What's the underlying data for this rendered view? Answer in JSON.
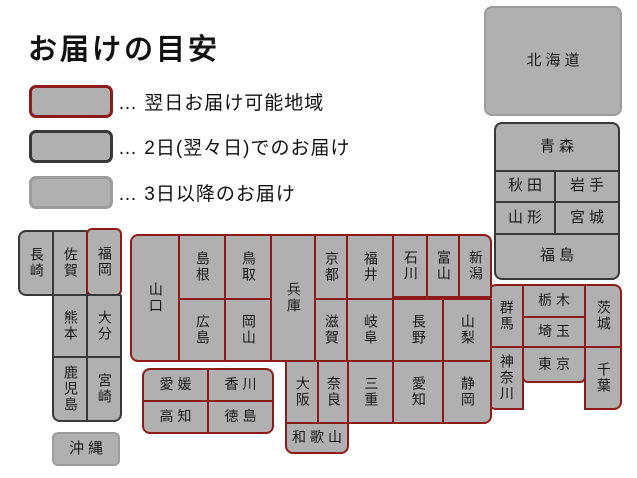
{
  "title": "お届けの目安",
  "legend": {
    "items": [
      {
        "zone": "next-day",
        "label": "… 翌日お届け可能地域"
      },
      {
        "zone": "two-days",
        "label": "… 2日(翌々日)でのお届け"
      },
      {
        "zone": "three-plus",
        "label": "… 3日以降のお届け"
      }
    ]
  },
  "colors": {
    "next-day": "#8e1b1b",
    "two-days": "#383838",
    "three-plus": "#9c9c9c",
    "fill": "#b0b0b0",
    "text": "#161616"
  },
  "map": {
    "boxes": [
      {
        "id": "hokkaido",
        "label": "北海道",
        "x": 484,
        "y": 6,
        "w": 136,
        "h": 108,
        "zone": "three-plus",
        "o": "h",
        "r": "8px",
        "big": true
      },
      {
        "id": "aomori",
        "label": "青森",
        "x": 494,
        "y": 122,
        "w": 124,
        "h": 48,
        "zone": "two-days",
        "o": "h",
        "r": "8px 8px 0 0",
        "big": true
      },
      {
        "id": "akita",
        "label": "秋田",
        "x": 494,
        "y": 170,
        "w": 60,
        "h": 31,
        "zone": "two-days",
        "o": "h",
        "big": true
      },
      {
        "id": "iwate",
        "label": "岩手",
        "x": 554,
        "y": 170,
        "w": 64,
        "h": 31,
        "zone": "two-days",
        "o": "h",
        "big": true
      },
      {
        "id": "yamagata",
        "label": "山形",
        "x": 494,
        "y": 201,
        "w": 60,
        "h": 32,
        "zone": "two-days",
        "o": "h",
        "big": true
      },
      {
        "id": "miyagi",
        "label": "宮城",
        "x": 554,
        "y": 201,
        "w": 64,
        "h": 32,
        "zone": "two-days",
        "o": "h",
        "big": true
      },
      {
        "id": "fukushima",
        "label": "福島",
        "x": 494,
        "y": 233,
        "w": 124,
        "h": 45,
        "zone": "two-days",
        "o": "h",
        "r": "0 0 8px 8px",
        "big": true
      },
      {
        "id": "gunma",
        "label": "群馬",
        "x": 488,
        "y": 284,
        "w": 34,
        "h": 62,
        "zone": "next-day",
        "o": "v",
        "r": "8px 0 0 0"
      },
      {
        "id": "tochigi",
        "label": "栃木",
        "x": 522,
        "y": 284,
        "w": 62,
        "h": 32,
        "zone": "next-day",
        "o": "h"
      },
      {
        "id": "saitama",
        "label": "埼玉",
        "x": 522,
        "y": 316,
        "w": 62,
        "h": 30,
        "zone": "next-day",
        "o": "h"
      },
      {
        "id": "ibaraki",
        "label": "茨城",
        "x": 584,
        "y": 284,
        "w": 36,
        "h": 62,
        "zone": "next-day",
        "o": "v",
        "r": "0 8px 0 0"
      },
      {
        "id": "kanagawa",
        "label": "神奈川",
        "x": 488,
        "y": 346,
        "w": 34,
        "h": 62,
        "zone": "next-day",
        "o": "v",
        "r": "0 0 0 8px"
      },
      {
        "id": "tokyo",
        "label": "東京",
        "x": 522,
        "y": 346,
        "w": 62,
        "h": 35,
        "zone": "next-day",
        "o": "h",
        "r": "0 0 6px 6px"
      },
      {
        "id": "chiba",
        "label": "千葉",
        "x": 584,
        "y": 346,
        "w": 36,
        "h": 62,
        "zone": "next-day",
        "o": "v",
        "r": "0 0 8px 0"
      },
      {
        "id": "nagasaki",
        "label": "長崎",
        "x": 18,
        "y": 230,
        "w": 34,
        "h": 64,
        "zone": "two-days",
        "o": "v",
        "r": "8px 0 0 8px"
      },
      {
        "id": "saga",
        "label": "佐賀",
        "x": 52,
        "y": 230,
        "w": 34,
        "h": 64,
        "zone": "two-days",
        "o": "v"
      },
      {
        "id": "fukuoka",
        "label": "福岡",
        "x": 86,
        "y": 228,
        "w": 34,
        "h": 66,
        "zone": "next-day",
        "o": "v",
        "r": "6px"
      },
      {
        "id": "kumamoto",
        "label": "熊本",
        "x": 52,
        "y": 294,
        "w": 34,
        "h": 62,
        "zone": "two-days",
        "o": "v"
      },
      {
        "id": "oita",
        "label": "大分",
        "x": 86,
        "y": 294,
        "w": 34,
        "h": 62,
        "zone": "two-days",
        "o": "v"
      },
      {
        "id": "kagoshima",
        "label": "鹿児島",
        "x": 52,
        "y": 356,
        "w": 34,
        "h": 64,
        "zone": "two-days",
        "o": "v",
        "r": "0 0 0 8px"
      },
      {
        "id": "miyazaki",
        "label": "宮崎",
        "x": 86,
        "y": 356,
        "w": 34,
        "h": 64,
        "zone": "two-days",
        "o": "v",
        "r": "0 0 8px 0"
      },
      {
        "id": "okinawa",
        "label": "沖縄",
        "x": 52,
        "y": 432,
        "w": 66,
        "h": 32,
        "zone": "three-plus",
        "o": "h",
        "r": "6px",
        "big": true
      },
      {
        "id": "yamaguchi",
        "label": "山口",
        "x": 130,
        "y": 234,
        "w": 48,
        "h": 126,
        "zone": "next-day",
        "o": "v",
        "r": "8px 0 0 8px"
      },
      {
        "id": "shimane",
        "label": "島根",
        "x": 178,
        "y": 234,
        "w": 46,
        "h": 64,
        "zone": "next-day",
        "o": "v"
      },
      {
        "id": "tottori",
        "label": "鳥取",
        "x": 224,
        "y": 234,
        "w": 46,
        "h": 64,
        "zone": "next-day",
        "o": "v"
      },
      {
        "id": "hiroshima",
        "label": "広島",
        "x": 178,
        "y": 298,
        "w": 46,
        "h": 62,
        "zone": "next-day",
        "o": "v"
      },
      {
        "id": "okayama",
        "label": "岡山",
        "x": 224,
        "y": 298,
        "w": 46,
        "h": 62,
        "zone": "next-day",
        "o": "v"
      },
      {
        "id": "hyogo",
        "label": "兵庫",
        "x": 270,
        "y": 234,
        "w": 44,
        "h": 126,
        "zone": "next-day",
        "o": "v"
      },
      {
        "id": "kyoto",
        "label": "京都",
        "x": 314,
        "y": 234,
        "w": 32,
        "h": 64,
        "zone": "next-day",
        "o": "v"
      },
      {
        "id": "fukui",
        "label": "福井",
        "x": 346,
        "y": 234,
        "w": 46,
        "h": 64,
        "zone": "next-day",
        "o": "v"
      },
      {
        "id": "ishikawa",
        "label": "石川",
        "x": 392,
        "y": 234,
        "w": 34,
        "h": 62,
        "zone": "next-day",
        "o": "v"
      },
      {
        "id": "toyama",
        "label": "富山",
        "x": 426,
        "y": 234,
        "w": 32,
        "h": 62,
        "zone": "next-day",
        "o": "v"
      },
      {
        "id": "niigata",
        "label": "新潟",
        "x": 458,
        "y": 234,
        "w": 32,
        "h": 62,
        "zone": "next-day",
        "o": "v",
        "r": "0 8px 0 0"
      },
      {
        "id": "shiga",
        "label": "滋賀",
        "x": 314,
        "y": 298,
        "w": 32,
        "h": 62,
        "zone": "next-day",
        "o": "v"
      },
      {
        "id": "gifu",
        "label": "岐阜",
        "x": 346,
        "y": 298,
        "w": 46,
        "h": 62,
        "zone": "next-day",
        "o": "v"
      },
      {
        "id": "nagano",
        "label": "長野",
        "x": 392,
        "y": 298,
        "w": 50,
        "h": 62,
        "zone": "next-day",
        "o": "v"
      },
      {
        "id": "yamanashi",
        "label": "山梨",
        "x": 442,
        "y": 298,
        "w": 48,
        "h": 62,
        "zone": "next-day",
        "o": "v"
      },
      {
        "id": "osaka",
        "label": "大阪",
        "x": 285,
        "y": 360,
        "w": 32,
        "h": 62,
        "zone": "next-day",
        "o": "v"
      },
      {
        "id": "nara",
        "label": "奈良",
        "x": 317,
        "y": 360,
        "w": 30,
        "h": 62,
        "zone": "next-day",
        "o": "v"
      },
      {
        "id": "mie",
        "label": "三重",
        "x": 347,
        "y": 360,
        "w": 45,
        "h": 62,
        "zone": "next-day",
        "o": "v"
      },
      {
        "id": "aichi",
        "label": "愛知",
        "x": 392,
        "y": 360,
        "w": 50,
        "h": 62,
        "zone": "next-day",
        "o": "v"
      },
      {
        "id": "shizuoka",
        "label": "静岡",
        "x": 442,
        "y": 360,
        "w": 48,
        "h": 62,
        "zone": "next-day",
        "o": "v",
        "r": "0 0 8px 0"
      },
      {
        "id": "wakayama",
        "label": "和歌山",
        "x": 285,
        "y": 422,
        "w": 62,
        "h": 30,
        "zone": "next-day",
        "o": "h",
        "r": "0 0 8px 8px"
      },
      {
        "id": "ehime",
        "label": "愛媛",
        "x": 142,
        "y": 368,
        "w": 65,
        "h": 32,
        "zone": "next-day",
        "o": "h",
        "r": "8px 0 0 0"
      },
      {
        "id": "kagawa",
        "label": "香川",
        "x": 207,
        "y": 368,
        "w": 65,
        "h": 32,
        "zone": "next-day",
        "o": "h",
        "r": "0 8px 0 0"
      },
      {
        "id": "kochi",
        "label": "高知",
        "x": 142,
        "y": 400,
        "w": 65,
        "h": 32,
        "zone": "next-day",
        "o": "h",
        "r": "0 0 0 8px"
      },
      {
        "id": "tokushima",
        "label": "徳島",
        "x": 207,
        "y": 400,
        "w": 65,
        "h": 32,
        "zone": "next-day",
        "o": "h",
        "r": "0 0 8px 0"
      }
    ]
  }
}
